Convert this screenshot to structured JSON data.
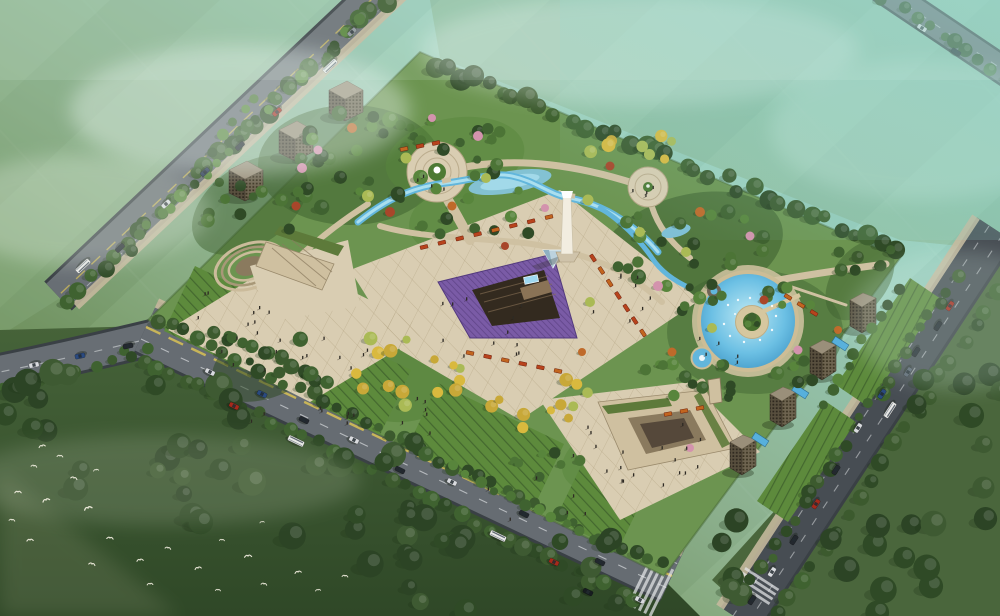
{
  "meta": {
    "type": "aerial-architectural-rendering",
    "subject": "Bird's-eye rendering of an urban park masterplan bounded by tree-lined boulevards, with central monument, sunken amphitheater, lavender parterre, circular fountain plaza, round pool with island, striped lawn terraces, cube pavilions and towers, traffic and a flock of birds",
    "width": 1000,
    "height": 616
  },
  "palette": {
    "skyTeal": "#8ed2c8",
    "mist": "#eaf6f1",
    "fieldLight": "#8fb487",
    "fieldMid": "#7fa372",
    "fieldDark": "#4a663c",
    "forest": "#3e5a32",
    "forestDark": "#2c4425",
    "roadA": "#686e74",
    "roadB": "#666c72",
    "roadDark": "#474d53",
    "roadEdge": "#3a4045",
    "laneYellow": "#d9c255",
    "laneWhite": "#d8dcde",
    "sidewalk": "#c4b89c",
    "plaza": "#d9cdb2",
    "plazaGrid": "#b4a584",
    "pathTan": "#cfc1a2",
    "lawn": "#5d8a3c",
    "lawnStripe": "#2f4c24",
    "hedge": "#3c5a2e",
    "green1": "#4c7436",
    "green2": "#3f6230",
    "green3": "#58853c",
    "green4": "#2f4a26",
    "yellow1": "#d9b93e",
    "yellow2": "#c8a838",
    "willow": "#aaba55",
    "autumn1": "#bf6a2a",
    "autumn2": "#a8462a",
    "pink": "#d393ad",
    "waterLight": "#aadfef",
    "water": "#62b6dc",
    "waterDeep": "#3e95c4",
    "lavender": "#7a5ba6",
    "lavenderDark": "#533a7e",
    "planterRed": "#b8431d",
    "planterOrange": "#c2651f",
    "buildTop": "#9a8f7a",
    "buildFaceL": "#584f3e",
    "buildFaceR": "#6e6450",
    "buildWin": "#2c261d",
    "monument": "#f2ede0",
    "stageDark": "#332a1f",
    "people": "#2e2a24",
    "bird": "#f4f0e2"
  },
  "scene": {
    "landmarks": [
      "central-monument-obelisk",
      "sunken-amphitheater-with-screen",
      "glass-pyramid",
      "lavender-parterre-triangle",
      "circular-fountain-plaza",
      "northeast-circular-plaza",
      "round-pool-with-island-and-fountains",
      "winding-stream",
      "striped-lawn-terraces",
      "ginkgo-groves-in-red-planters",
      "three-cube-pavilions",
      "four-towers-with-blue-pools",
      "west-amphitheater",
      "south-courtyard-complex",
      "boulevards-with-cars-and-buses",
      "bird-flock-over-forest"
    ]
  },
  "groundPatches": [
    [
      350,
      165,
      92,
      60,
      0,
      "green2",
      0.55
    ],
    [
      455,
      158,
      70,
      40,
      -10,
      "green3",
      0.5
    ],
    [
      690,
      250,
      95,
      55,
      -15,
      "green2",
      0.6
    ],
    [
      755,
      332,
      88,
      62,
      0,
      "green2",
      0.45
    ],
    [
      410,
      370,
      66,
      50,
      -20,
      "green3",
      0.7
    ],
    [
      640,
      452,
      80,
      40,
      -15,
      "green3",
      0.5
    ],
    [
      270,
      360,
      62,
      36,
      -25,
      "green4",
      0.55
    ],
    [
      480,
      215,
      72,
      40,
      -12,
      "green3",
      0.5
    ],
    [
      250,
      205,
      65,
      40,
      -35,
      "green2",
      0.5
    ],
    [
      860,
      280,
      45,
      28,
      -55,
      "green2",
      0.5
    ]
  ],
  "treeSets": {
    "dark": [
      "green2",
      "green4",
      "hedge"
    ],
    "mixed": [
      "green1",
      "green2",
      "green3",
      "green4"
    ],
    "yellow": [
      "yellow1",
      "yellow2",
      "willow"
    ],
    "forest": [
      "forest",
      "forestDark",
      "green4"
    ],
    "hedgerow": [
      "hedge",
      "green4",
      "green2"
    ]
  },
  "treeRows": [
    [
      432,
      64,
      893,
      248,
      34,
      6,
      11,
      6,
      "dark"
    ],
    [
      384,
      2,
      66,
      298,
      28,
      6,
      10,
      5,
      "dark"
    ],
    [
      356,
      22,
      128,
      248,
      22,
      4,
      7,
      4,
      "mixed"
    ],
    [
      158,
      320,
      660,
      566,
      40,
      4,
      8,
      4,
      "hedgerow"
    ],
    [
      128,
      352,
      636,
      600,
      36,
      5,
      9,
      4,
      "dark"
    ],
    [
      956,
      278,
      744,
      594,
      26,
      4,
      8,
      4,
      "hedgerow"
    ],
    [
      998,
      292,
      778,
      616,
      20,
      5,
      9,
      4,
      "dark"
    ],
    [
      886,
      0,
      1008,
      78,
      10,
      4,
      8,
      6,
      "dark"
    ],
    [
      150,
      352,
      4,
      388,
      9,
      4,
      7,
      4,
      "dark"
    ],
    [
      215,
      330,
      330,
      385,
      10,
      5,
      8,
      3,
      "dark"
    ],
    [
      898,
      292,
      822,
      404,
      10,
      4,
      6,
      3,
      "mixed"
    ],
    [
      452,
      468,
      610,
      544,
      12,
      4,
      6,
      3,
      "mixed"
    ],
    [
      256,
      96,
      212,
      150,
      5,
      4,
      6,
      3,
      "mixed"
    ]
  ],
  "treeClusters": [
    [
      352,
      162,
      72,
      50,
      24,
      4,
      8,
      "mixed"
    ],
    [
      452,
      150,
      58,
      32,
      14,
      4,
      7,
      "mixed"
    ],
    [
      688,
      248,
      78,
      42,
      22,
      4,
      8,
      "mixed"
    ],
    [
      700,
      300,
      24,
      16,
      5,
      4,
      7,
      "mixed"
    ],
    [
      792,
      298,
      28,
      18,
      6,
      4,
      7,
      "mixed"
    ],
    [
      802,
      368,
      26,
      16,
      6,
      4,
      7,
      "mixed"
    ],
    [
      702,
      390,
      30,
      16,
      6,
      4,
      7,
      "mixed"
    ],
    [
      688,
      380,
      48,
      22,
      8,
      4,
      7,
      "mixed"
    ],
    [
      560,
      468,
      48,
      20,
      7,
      4,
      6,
      "mixed"
    ],
    [
      268,
      358,
      52,
      28,
      10,
      5,
      8,
      "dark"
    ],
    [
      408,
      368,
      56,
      42,
      15,
      4,
      7,
      "yellow"
    ],
    [
      540,
      404,
      52,
      28,
      11,
      4,
      7,
      "yellow"
    ],
    [
      622,
      148,
      52,
      22,
      8,
      4,
      7,
      "yellow"
    ],
    [
      480,
      212,
      64,
      32,
      10,
      4,
      7,
      "mixed"
    ],
    [
      248,
      208,
      58,
      32,
      11,
      4,
      7,
      "mixed"
    ],
    [
      866,
      260,
      30,
      18,
      7,
      4,
      7,
      "dark"
    ],
    [
      120,
      428,
      130,
      65,
      20,
      8,
      14,
      "forest"
    ],
    [
      330,
      500,
      160,
      68,
      22,
      8,
      14,
      "forest"
    ],
    [
      520,
      572,
      130,
      46,
      14,
      8,
      13,
      "forest"
    ],
    [
      846,
      556,
      140,
      58,
      15,
      9,
      14,
      "forest"
    ],
    [
      952,
      444,
      60,
      90,
      10,
      8,
      13,
      "forest"
    ]
  ],
  "treeSingles": [
    [
      302,
      168,
      5,
      "pink"
    ],
    [
      318,
      150,
      4.5,
      "pink"
    ],
    [
      478,
      136,
      5,
      "pink"
    ],
    [
      658,
      286,
      5,
      "pink"
    ],
    [
      750,
      236,
      4.5,
      "pink"
    ],
    [
      798,
      350,
      4.5,
      "pink"
    ],
    [
      432,
      118,
      4,
      "pink"
    ],
    [
      545,
      208,
      4,
      "pink"
    ],
    [
      690,
      448,
      4,
      "pink"
    ],
    [
      352,
      128,
      5,
      "autumn1"
    ],
    [
      390,
      212,
      5,
      "autumn2"
    ],
    [
      452,
      206,
      4.5,
      "autumn1"
    ],
    [
      610,
      166,
      4.5,
      "autumn2"
    ],
    [
      700,
      212,
      5,
      "autumn1"
    ],
    [
      764,
      300,
      4.5,
      "autumn2"
    ],
    [
      672,
      352,
      4.5,
      "autumn1"
    ],
    [
      296,
      206,
      4.5,
      "autumn2"
    ],
    [
      838,
      330,
      4,
      "autumn1"
    ],
    [
      505,
      246,
      4,
      "autumn2"
    ],
    [
      582,
      352,
      4,
      "autumn1"
    ],
    [
      368,
      196,
      6,
      "willow"
    ],
    [
      406,
      158,
      5.5,
      "willow"
    ],
    [
      588,
      200,
      5.5,
      "willow"
    ],
    [
      640,
      232,
      5,
      "willow"
    ],
    [
      686,
      252,
      5,
      "willow"
    ],
    [
      590,
      302,
      5,
      "willow"
    ],
    [
      712,
      328,
      5,
      "willow"
    ],
    [
      486,
      178,
      5,
      "willow"
    ],
    [
      752,
      317,
      4.5,
      "green2"
    ],
    [
      748,
      324,
      3.5,
      "green3"
    ],
    [
      757,
      324,
      3,
      "green4"
    ]
  ],
  "planterRows": [
    [
      424,
      247,
      549,
      217,
      8,
      -14
    ],
    [
      593,
      258,
      643,
      333,
      7,
      57
    ],
    [
      470,
      353,
      558,
      371,
      6,
      12
    ],
    [
      404,
      149,
      436,
      143,
      3,
      -12
    ],
    [
      668,
      414,
      700,
      408,
      3,
      -10
    ],
    [
      788,
      297,
      814,
      313,
      3,
      31
    ]
  ],
  "crowds": [
    [
      300,
      345,
      80,
      38,
      16
    ],
    [
      480,
      330,
      60,
      32,
      12
    ],
    [
      610,
      300,
      48,
      26,
      8
    ],
    [
      640,
      450,
      70,
      32,
      14
    ],
    [
      437,
      186,
      24,
      10,
      4
    ],
    [
      648,
      196,
      20,
      9,
      4
    ],
    [
      390,
      420,
      50,
      24,
      8
    ],
    [
      228,
      310,
      40,
      18,
      6
    ],
    [
      718,
      352,
      28,
      16,
      5
    ],
    [
      540,
      500,
      58,
      24,
      6
    ],
    [
      300,
      420,
      50,
      20,
      6
    ],
    [
      660,
      480,
      40,
      16,
      5
    ]
  ],
  "vehicles": [
    [
      352,
      32,
      137,
      "#8e9499",
      "car"
    ],
    [
      330,
      66,
      137,
      "#e9e9e7",
      "bus"
    ],
    [
      277,
      112,
      137,
      "#a52a1c",
      "car"
    ],
    [
      240,
      146,
      137,
      "#23282e",
      "car"
    ],
    [
      205,
      172,
      137,
      "#31405a",
      "car"
    ],
    [
      166,
      204,
      137,
      "#d9dbdf",
      "car"
    ],
    [
      120,
      248,
      137,
      "#23282e",
      "car"
    ],
    [
      83,
      266,
      137,
      "#e9e9e7",
      "bus"
    ],
    [
      128,
      346,
      168,
      "#23282e",
      "car"
    ],
    [
      80,
      356,
      168,
      "#2a4a80",
      "car"
    ],
    [
      34,
      365,
      168,
      "#d9dbdf",
      "car"
    ],
    [
      210,
      372,
      26,
      "#d9dbdf",
      "car"
    ],
    [
      262,
      394,
      26,
      "#2a4a80",
      "car"
    ],
    [
      234,
      406,
      26,
      "#a52a1c",
      "car"
    ],
    [
      304,
      420,
      26,
      "#23282e",
      "car"
    ],
    [
      296,
      441,
      26,
      "#e9e9e7",
      "bus"
    ],
    [
      354,
      440,
      26,
      "#d9dbdf",
      "car"
    ],
    [
      400,
      470,
      26,
      "#23282e",
      "car"
    ],
    [
      452,
      482,
      26,
      "#d9dbdf",
      "car"
    ],
    [
      498,
      536,
      26,
      "#e9e9e7",
      "bus"
    ],
    [
      524,
      514,
      26,
      "#23282e",
      "car"
    ],
    [
      554,
      562,
      26,
      "#a52a1c",
      "car"
    ],
    [
      600,
      562,
      26,
      "#23282e",
      "car"
    ],
    [
      588,
      592,
      26,
      "#171c20",
      "car"
    ],
    [
      640,
      600,
      26,
      "#d9dbdf",
      "car"
    ],
    [
      950,
      306,
      123,
      "#a52a1c",
      "car"
    ],
    [
      938,
      326,
      123,
      "#23282e",
      "car"
    ],
    [
      916,
      352,
      123,
      "#23282e",
      "car"
    ],
    [
      908,
      372,
      123,
      "#5a6470",
      "car"
    ],
    [
      882,
      394,
      123,
      "#2a4a80",
      "car"
    ],
    [
      890,
      410,
      123,
      "#e9e9e7",
      "bus"
    ],
    [
      858,
      428,
      123,
      "#d9dbdf",
      "car"
    ],
    [
      836,
      470,
      123,
      "#23282e",
      "car"
    ],
    [
      816,
      504,
      123,
      "#a52a1c",
      "car"
    ],
    [
      794,
      540,
      123,
      "#23282e",
      "car"
    ],
    [
      772,
      572,
      123,
      "#d9dbdf",
      "car"
    ],
    [
      752,
      600,
      123,
      "#23282e",
      "car"
    ],
    [
      922,
      28,
      33,
      "#d9dbdf",
      "car"
    ],
    [
      956,
      52,
      33,
      "#23282e",
      "car"
    ]
  ],
  "birds": [
    [
      42,
      446,
      -15,
      1
    ],
    [
      34,
      466,
      10,
      0.9
    ],
    [
      18,
      492,
      0,
      1
    ],
    [
      46,
      500,
      -20,
      1.1
    ],
    [
      12,
      520,
      8,
      0.9
    ],
    [
      30,
      540,
      -5,
      1
    ],
    [
      74,
      478,
      15,
      1
    ],
    [
      96,
      470,
      -10,
      0.8
    ],
    [
      60,
      456,
      5,
      0.9
    ],
    [
      88,
      508,
      -18,
      1.2
    ],
    [
      110,
      538,
      6,
      1
    ],
    [
      140,
      560,
      -8,
      1
    ],
    [
      168,
      548,
      12,
      0.9
    ],
    [
      198,
      568,
      -14,
      1
    ],
    [
      222,
      540,
      4,
      0.8
    ],
    [
      248,
      556,
      -6,
      1.1
    ],
    [
      264,
      584,
      10,
      0.9
    ],
    [
      298,
      572,
      -12,
      1
    ],
    [
      218,
      590,
      5,
      0.8
    ],
    [
      150,
      584,
      -4,
      0.9
    ],
    [
      92,
      564,
      14,
      1
    ],
    [
      318,
      590,
      -8,
      0.8
    ],
    [
      345,
      576,
      6,
      0.9
    ],
    [
      262,
      522,
      -10,
      0.7
    ]
  ]
}
